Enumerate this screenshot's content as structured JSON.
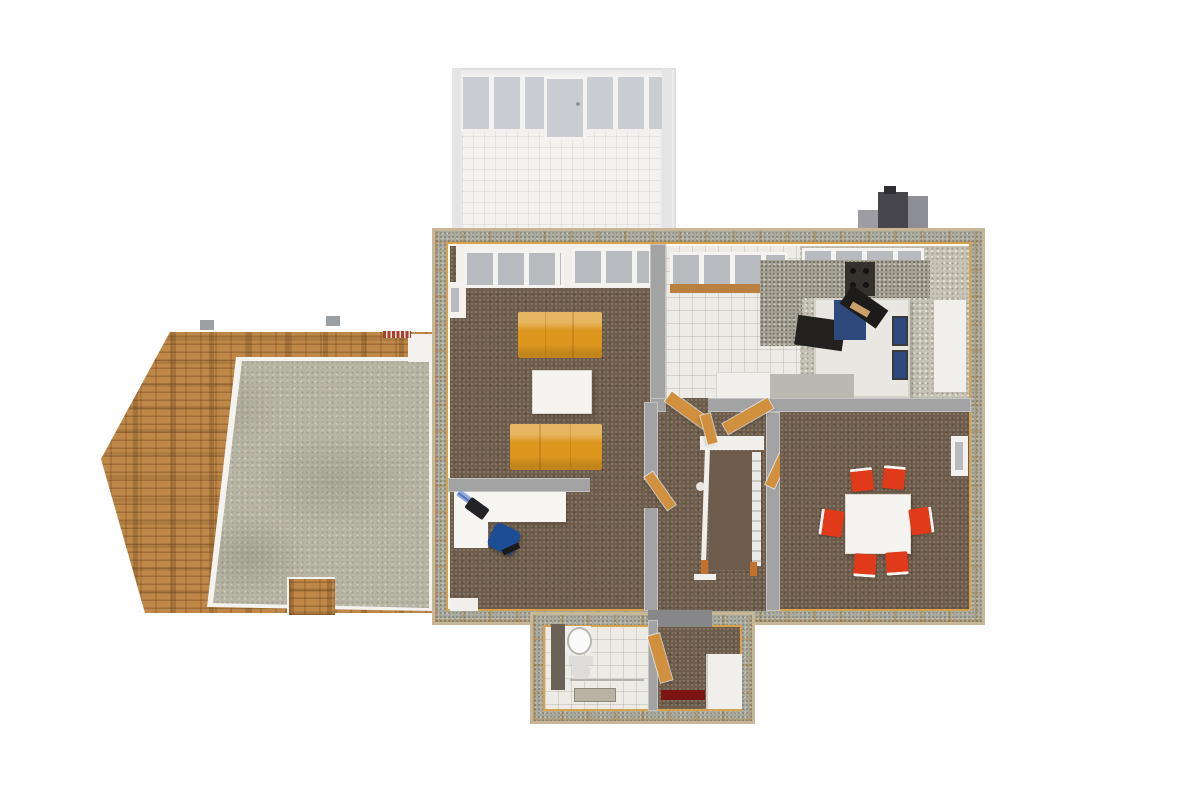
{
  "scene": {
    "name": "dollhouse-overhead-3d-floorplan-render",
    "background": "#ffffff",
    "rooms": [
      {
        "id": "sunroom-porch",
        "contents": [
          "glazed-door-wall",
          "ghost-tile-floor"
        ]
      },
      {
        "id": "living-room",
        "contents": [
          "sofa",
          "sofa",
          "coffee-table",
          "window-wall",
          "bay-window"
        ]
      },
      {
        "id": "kitchen",
        "contents": [
          "granite-counter",
          "range",
          "kitchen-island",
          "blue-appliance",
          "wood-stove",
          "hearth-pad",
          "window-band",
          "garden-sill",
          "counter-gray",
          "cabinet"
        ]
      },
      {
        "id": "dining-room",
        "contents": [
          "dining-table",
          "dining-chair",
          "dining-chair",
          "dining-chair",
          "dining-chair",
          "dining-chair",
          "dining-chair",
          "window"
        ]
      },
      {
        "id": "office",
        "contents": [
          "l-desk",
          "office-chair",
          "laptop",
          "papers"
        ]
      },
      {
        "id": "hallway",
        "contents": [
          "staircase",
          "stair-rail",
          "open-wood-doors",
          "landing"
        ]
      },
      {
        "id": "bathroom",
        "contents": [
          "vanity",
          "sink",
          "toilet",
          "towel-bar",
          "bath-rug"
        ]
      },
      {
        "id": "entry",
        "contents": [
          "front-door-mat",
          "open-wood-door",
          "closet"
        ]
      },
      {
        "id": "garage",
        "contents": [
          "brick-walls",
          "concrete-slab",
          "brick-pier",
          "side-door",
          "dentil-lintel"
        ]
      },
      {
        "id": "chimney",
        "contents": [
          "flue"
        ]
      }
    ]
  },
  "colors": {
    "background": "#ffffff",
    "wall_band": "#a8a89d",
    "wall_lip": "#c8b796",
    "wall_wood": "#d8a24b",
    "partition": "#a3a3a3",
    "interior_white": "#faf9f5",
    "carpet": "#6d5c4b",
    "tile": "#edebe6",
    "tile_bath": "#efecea",
    "floor_speckle": "#c6c3b6",
    "granite": "#a29e92",
    "concrete": "#b8b5a5",
    "brick": "#bf8848",
    "brick_dentil": "#a8402c",
    "ghost_frame": "#ebebeb",
    "glass": "#c6cacf",
    "window_glass": "#b7bbc0",
    "sofa": "#dd971f",
    "table_white": "#f5f4f0",
    "chair_red": "#e13a1a",
    "chair_blue": "#1c4d95",
    "desk_white": "#f6f5f1",
    "laptop_dark": "#232327",
    "paper_blue": "#8fa9d8",
    "wood_door": "#d0903d",
    "stair_rail": "#f0efeb",
    "newel_wood": "#c2722c",
    "range_dark": "#35312d",
    "island": "#e9e7e1",
    "appliance_blue": "#2e4a7c",
    "hearth": "#232120",
    "stove_black": "#1e1c1a",
    "log_tan": "#c9a06a",
    "counter_gray": "#b9b9b2",
    "cabinet_white": "#f0efeb",
    "chimney_dark": "#46464c",
    "chimney_light": "#8d8d95",
    "chimney_step": "#9c9ca2",
    "vanity_dark": "#6b6156",
    "porcelain": "#dddcd8",
    "mat_red": "#7c1511",
    "rug_beige": "#b9b3a4",
    "threshold": "#87878a",
    "sill_wood": "#b9803f",
    "gray_tab": "#9aa0a4"
  }
}
